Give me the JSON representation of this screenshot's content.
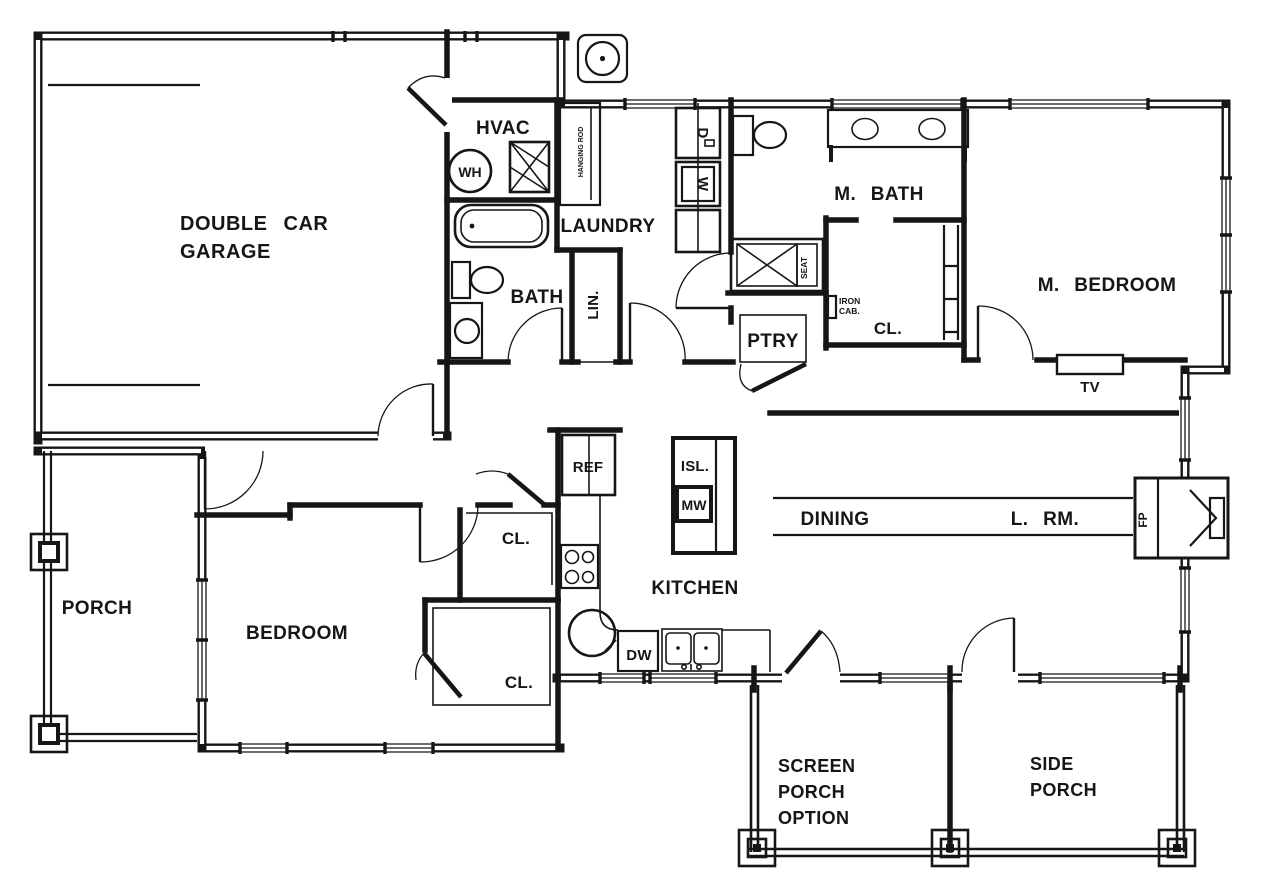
{
  "labels": {
    "garage_line1": "DOUBLE CAR",
    "garage_line2": "GARAGE",
    "hvac": "HVAC",
    "water_heater": "WH",
    "laundry": "LAUNDRY",
    "hanging_rod": "HANGING ROD",
    "dryer": "D",
    "washer": "W",
    "bath": "BATH",
    "linen": "LIN.",
    "master_bath": "M. BATH",
    "seat": "SEAT",
    "iron_cab_line1": "IRON",
    "iron_cab_line2": "CAB.",
    "master_closet": "CL.",
    "pantry": "PTRY",
    "master_bedroom": "M. BEDROOM",
    "tv": "TV",
    "porch": "PORCH",
    "bedroom": "BEDROOM",
    "closet_upper": "CL.",
    "closet_lower": "CL.",
    "refrigerator": "REF",
    "island": "ISL.",
    "microwave": "MW",
    "kitchen": "KITCHEN",
    "dishwasher": "DW",
    "dining": "DINING",
    "living_room": "L. RM.",
    "fireplace": "FP",
    "screen_porch_line1": "SCREEN",
    "screen_porch_line2": "PORCH",
    "screen_porch_line3": "OPTION",
    "side_porch_line1": "SIDE",
    "side_porch_line2": "PORCH"
  },
  "colors": {
    "ink": "#161616",
    "paper": "#ffffff"
  }
}
